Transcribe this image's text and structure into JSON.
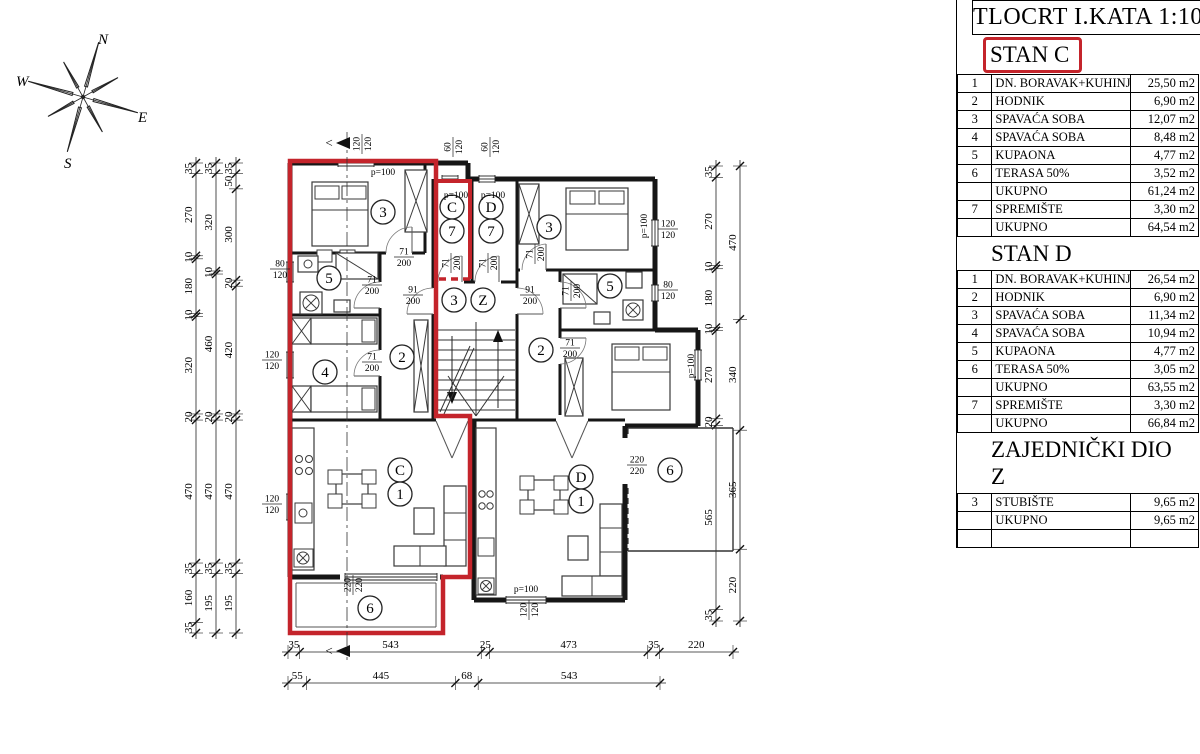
{
  "title": "TLOCRT I.KATA 1:100",
  "compass": {
    "n": "N",
    "e": "E",
    "s": "S",
    "w": "W"
  },
  "apartments": [
    {
      "name": "STAN C",
      "highlight": true,
      "rows": [
        {
          "n": "1",
          "label": "DN. BORAVAK+KUHINJA",
          "area": "25,50 m2"
        },
        {
          "n": "2",
          "label": "HODNIK",
          "area": "6,90 m2"
        },
        {
          "n": "3",
          "label": "SPAVAĆA SOBA",
          "area": "12,07 m2"
        },
        {
          "n": "4",
          "label": "SPAVAĆA SOBA",
          "area": "8,48 m2"
        },
        {
          "n": "5",
          "label": "KUPAONA",
          "area": "4,77 m2"
        },
        {
          "n": "6",
          "label": "TERASA 50%",
          "area": "3,52 m2"
        },
        {
          "n": "",
          "label": "UKUPNO",
          "area": "61,24 m2"
        },
        {
          "n": "7",
          "label": "SPREMIŠTE",
          "area": "3,30 m2"
        },
        {
          "n": "",
          "label": "UKUPNO",
          "area": "64,54 m2"
        }
      ]
    },
    {
      "name": "STAN D",
      "highlight": false,
      "rows": [
        {
          "n": "1",
          "label": "DN. BORAVAK+KUHINJA",
          "area": "26,54 m2"
        },
        {
          "n": "2",
          "label": "HODNIK",
          "area": "6,90 m2"
        },
        {
          "n": "3",
          "label": "SPAVAĆA SOBA",
          "area": "11,34 m2"
        },
        {
          "n": "4",
          "label": "SPAVAĆA SOBA",
          "area": "10,94 m2"
        },
        {
          "n": "5",
          "label": "KUPAONA",
          "area": "4,77 m2"
        },
        {
          "n": "6",
          "label": "TERASA 50%",
          "area": "3,05 m2"
        },
        {
          "n": "",
          "label": "UKUPNO",
          "area": "63,55 m2"
        },
        {
          "n": "7",
          "label": "SPREMIŠTE",
          "area": "3,30 m2"
        },
        {
          "n": "",
          "label": "UKUPNO",
          "area": "66,84 m2"
        }
      ]
    },
    {
      "name": "ZAJEDNIČKI DIO Z",
      "highlight": false,
      "rows": [
        {
          "n": "3",
          "label": "STUBIŠTE",
          "area": "9,65 m2"
        },
        {
          "n": "",
          "label": "UKUPNO",
          "area": "9,65 m2"
        },
        {
          "n": "",
          "label": "",
          "area": ""
        }
      ]
    }
  ],
  "plan": {
    "room_labels": [
      "3",
      "5",
      "4",
      "2",
      "C",
      "7",
      "D",
      "7",
      "3",
      "Z",
      "3",
      "5",
      "2",
      "C",
      "1",
      "D",
      "1",
      "6",
      "6"
    ],
    "dim_left": [
      [
        "35",
        "270",
        "10",
        "180",
        "10",
        "320",
        "20",
        "470",
        "35",
        "160",
        "35"
      ],
      [
        "35",
        "320",
        "10",
        "460",
        "20",
        "470",
        "35",
        "195"
      ],
      [
        "35",
        "50",
        "300",
        "20",
        "420",
        "20",
        "470",
        "35",
        "195"
      ]
    ],
    "dim_right": [
      [
        "35",
        "270",
        "10",
        "180",
        "10",
        "270",
        "20",
        "565",
        "35"
      ],
      [
        "470",
        "340",
        "365",
        "220"
      ]
    ],
    "dim_bottom": [
      [
        "35",
        "543",
        "25",
        "473",
        "35",
        "220"
      ],
      [
        "55",
        "445",
        "68",
        "543"
      ]
    ],
    "annotations": {
      "p100": "p=100",
      "d71": [
        "71",
        "200"
      ],
      "d91": [
        "91",
        "200"
      ],
      "w60": [
        "60",
        "120"
      ],
      "w80": [
        "80",
        "120"
      ],
      "w120": [
        "120",
        "120"
      ],
      "w220": [
        "220",
        "220"
      ]
    }
  }
}
